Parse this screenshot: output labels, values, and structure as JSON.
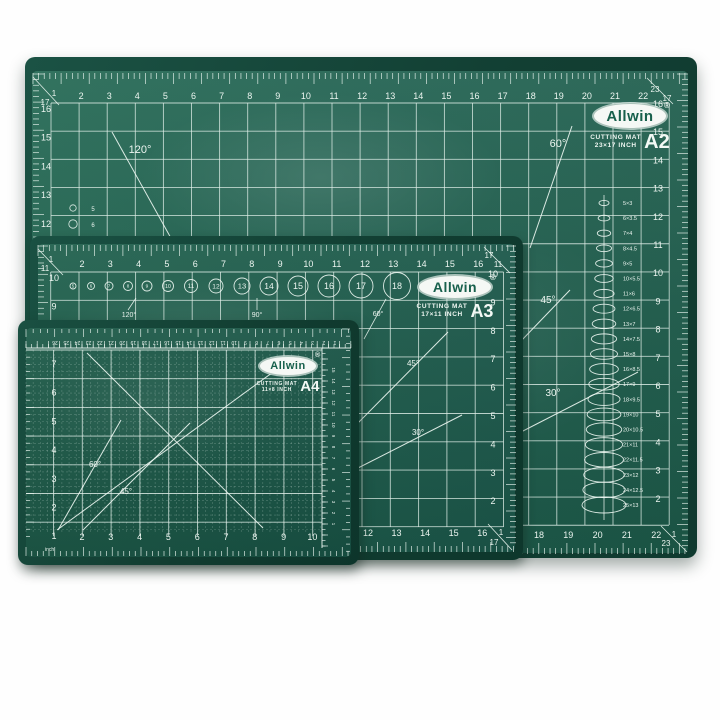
{
  "colors": {
    "mat_surface": "#20614f",
    "mat_rim": "#113c31",
    "grid_line": "#e2f0ea",
    "tick_line": "#eef8f3",
    "number_text": "#ecf5f0",
    "logo_bg": "#f5f8f5",
    "logo_text": "#17604c"
  },
  "a2": {
    "brand": "Allwin",
    "reg_mark": "®",
    "product_name": "CUTTING MAT",
    "dimension_label": "23×17 INCH",
    "size_code": "A2",
    "top_numbers": [
      "2",
      "3",
      "4",
      "5",
      "6",
      "7",
      "8",
      "9",
      "10",
      "11",
      "12",
      "13",
      "14",
      "15",
      "16",
      "17",
      "18",
      "19",
      "20",
      "21",
      "22"
    ],
    "left_numbers": [
      "16",
      "15",
      "14",
      "13",
      "12"
    ],
    "right_numbers": [
      "16",
      "15",
      "14",
      "13",
      "12",
      "11",
      "10",
      "9",
      "8",
      "7",
      "6",
      "5",
      "4",
      "3",
      "2"
    ],
    "bottom_numbers": [
      "18",
      "19",
      "20",
      "21",
      "22"
    ],
    "corner_tl": {
      "col": "1",
      "row": "17"
    },
    "corner_tr": {
      "col": "23",
      "row": "17"
    },
    "corner_br": {
      "row": "1",
      "col": "23"
    },
    "angle_labels": {
      "a120": "120°",
      "a60": "60°",
      "a45": "45°",
      "a30": "30°"
    },
    "circle_labels": [
      "5",
      "6"
    ],
    "ellipse_labels": [
      "5×3",
      "6×3.5",
      "7×4",
      "8×4.5",
      "9×5",
      "10×5.5",
      "11×6",
      "12×6.5",
      "13×7",
      "14×7.5",
      "15×8",
      "16×8.5",
      "17×9",
      "18×9.5",
      "19×10",
      "20×10.5",
      "21×11",
      "22×11.5",
      "23×12",
      "24×12.5",
      "25×13"
    ]
  },
  "a3": {
    "brand": "Allwin",
    "reg_mark": "®",
    "product_name": "CUTTING MAT",
    "dimension_label": "17×11 INCH",
    "size_code": "A3",
    "top_numbers": [
      "2",
      "3",
      "4",
      "5",
      "6",
      "7",
      "8",
      "9",
      "10",
      "11",
      "12",
      "13",
      "14",
      "15",
      "16"
    ],
    "left_numbers": [
      "10",
      "9"
    ],
    "right_numbers": [
      "10",
      "9",
      "8",
      "7",
      "6",
      "5",
      "4",
      "3",
      "2"
    ],
    "bottom_numbers": [
      "12",
      "13",
      "14",
      "15",
      "16"
    ],
    "corner_tl": {
      "col": "1",
      "row": "11"
    },
    "corner_tr": {
      "col": "17",
      "row": "11"
    },
    "corner_br": {
      "row": "1",
      "col": "17"
    },
    "circled_numbers": [
      "5",
      "6",
      "7",
      "8",
      "9",
      "10",
      "11",
      "12",
      "13",
      "14",
      "15",
      "16",
      "17",
      "18"
    ],
    "angle_labels": {
      "a120": "120°",
      "a90": "90°",
      "a60": "60°",
      "a45": "45°",
      "a30": "30°"
    }
  },
  "a4": {
    "brand": "Allwin",
    "reg_mark": "®",
    "product_name": "CUTTING MAT",
    "dimension_label": "11×8 INCH",
    "size_code": "A4",
    "left_numbers": [
      "7",
      "6",
      "5",
      "4",
      "3",
      "2",
      "1"
    ],
    "bottom_numbers": [
      "2",
      "3",
      "4",
      "5",
      "6",
      "7",
      "8",
      "9",
      "10"
    ],
    "cm_top_numbers": [
      "26",
      "25",
      "24",
      "23",
      "22",
      "21",
      "20",
      "19",
      "18",
      "17",
      "16",
      "15",
      "14",
      "13",
      "12",
      "11",
      "10",
      "9",
      "8",
      "7",
      "6",
      "5",
      "4",
      "3",
      "2",
      "1"
    ],
    "cm_right_numbers": [
      "15",
      "14",
      "13",
      "12",
      "11",
      "10",
      "9",
      "8",
      "7",
      "6",
      "5",
      "4",
      "3",
      "2",
      "1"
    ],
    "unit_label": "inch",
    "angle_labels": {
      "a60": "60°",
      "a45": "45°"
    }
  }
}
